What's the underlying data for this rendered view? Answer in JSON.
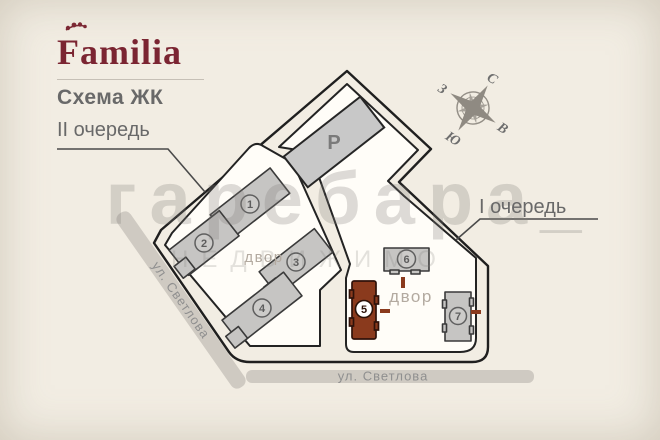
{
  "title": {
    "brand": "Familia",
    "subtitle": "Схема ЖК"
  },
  "phase_labels": {
    "phase2": "II очередь",
    "phase1": "I очередь"
  },
  "compass": {
    "n": "С",
    "e": "В",
    "s": "Ю",
    "w": "З"
  },
  "streets": {
    "left": "ул. Светлова",
    "bottom": "ул. Светлова"
  },
  "parking": {
    "label": "Р"
  },
  "courtyards": {
    "left": "двор",
    "right": "двор"
  },
  "buildings": [
    {
      "number": "1",
      "highlighted": false
    },
    {
      "number": "2",
      "highlighted": false
    },
    {
      "number": "3",
      "highlighted": false
    },
    {
      "number": "4",
      "highlighted": false
    },
    {
      "number": "5",
      "highlighted": true
    },
    {
      "number": "6",
      "highlighted": false
    },
    {
      "number": "7",
      "highlighted": false
    }
  ],
  "watermark": {
    "line1": "гаребара_",
    "line2": "НЕДВИЖИМО"
  },
  "colors": {
    "background": "#f2ede3",
    "brand": "#7b2532",
    "plan_fill": "#fffdf8",
    "outline": "#1f1f1f",
    "building_gray": "#c6c5c3",
    "building_highlight": "#8a3a1d",
    "entrance_tick": "#8a3a1d",
    "street_band": "#cfcac2",
    "label_gray": "#696969",
    "courtyard_text": "#b3aaa0",
    "street_text": "#8f8f8f"
  }
}
